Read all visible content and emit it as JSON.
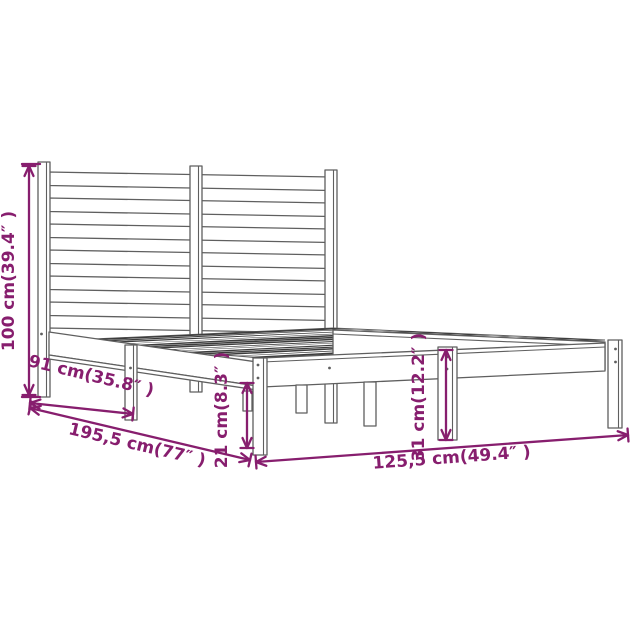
{
  "diagram": {
    "subject": "bed-frame-with-slatted-headboard-dimension-drawing",
    "colors": {
      "dim": "#871e6e",
      "line": "#5f5f5f",
      "slatfill": "#3c3c3c",
      "bg": "#ffffff"
    },
    "dimensions": {
      "height": {
        "cm": "100",
        "inch": "39.4",
        "label": "100 cm(39.4″ )"
      },
      "side": {
        "cm": "91",
        "inch": "35.8",
        "label": "91 cm(35.8″ )"
      },
      "length": {
        "cm": "195,5",
        "inch": "77",
        "label": "195,5 cm(77″ )"
      },
      "clearance": {
        "cm": "21",
        "inch": "8.3",
        "label": "21 cm(8.3″ )"
      },
      "platform_height": {
        "cm": "31",
        "inch": "12.2",
        "label": "31 cm(12.2″ )"
      },
      "width": {
        "cm": "125,5",
        "inch": "49.4",
        "label": "125,5 cm(49.4″ )"
      }
    }
  }
}
